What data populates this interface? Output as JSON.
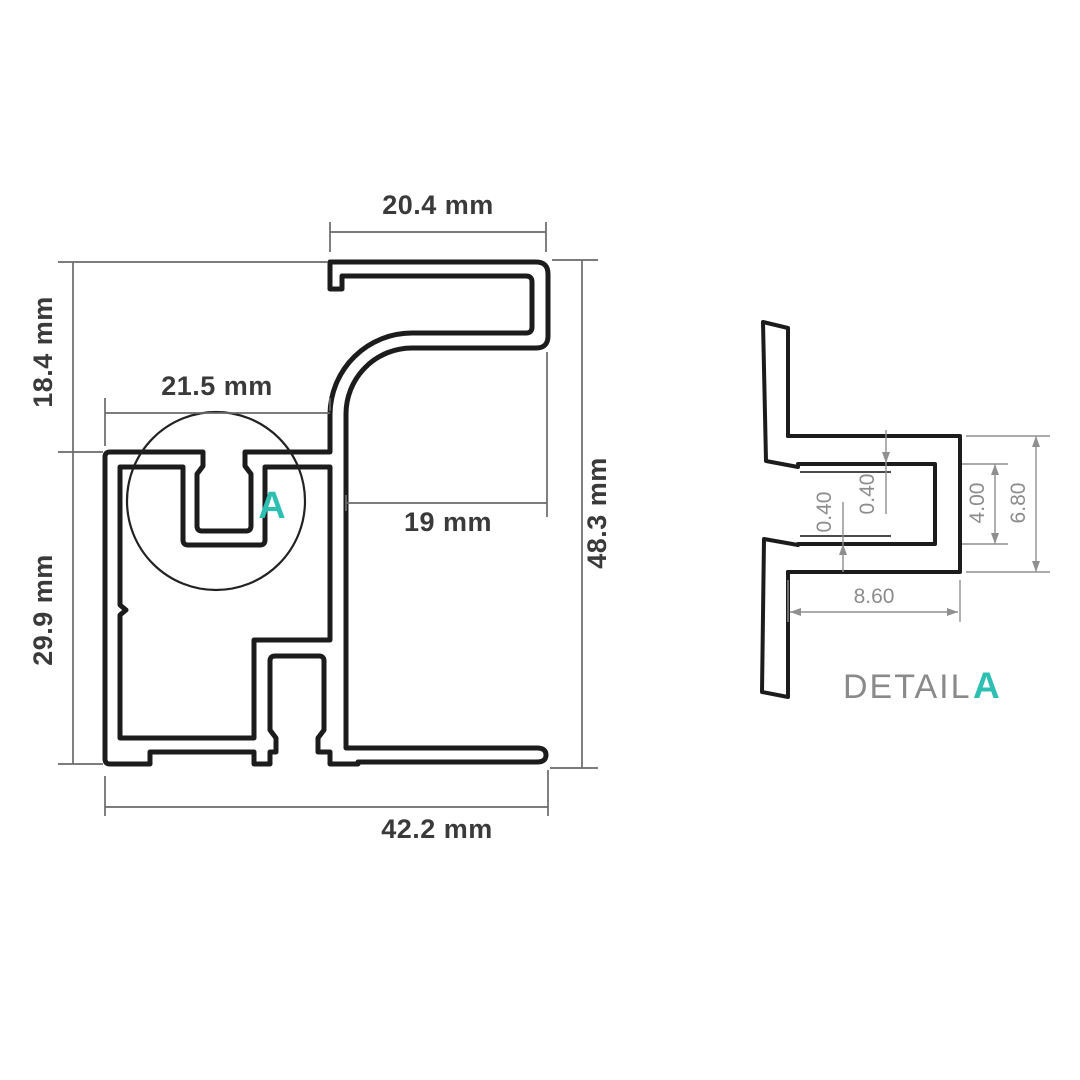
{
  "main_view": {
    "dims": {
      "top_width": "20.4 mm",
      "upper_height": "18.4 mm",
      "channel_width": "21.5 mm",
      "hook_depth": "19 mm",
      "overall_height": "48.3 mm",
      "lower_height": "29.9 mm",
      "overall_width": "42.2 mm"
    },
    "detail_marker": "A"
  },
  "detail_view": {
    "label": "DETAIL",
    "marker": "A",
    "dims": {
      "top_lip_step": "0.40",
      "bottom_lip_step": "0.40",
      "slot_opening": "4.00",
      "slot_overall": "6.80",
      "slot_depth": "8.60"
    }
  },
  "colors": {
    "accent": "#2EBFB3",
    "profile_line": "#1C1C1C",
    "dimension_line": "#6A6A6A",
    "detail_dimension_line": "#8F8F8F"
  }
}
